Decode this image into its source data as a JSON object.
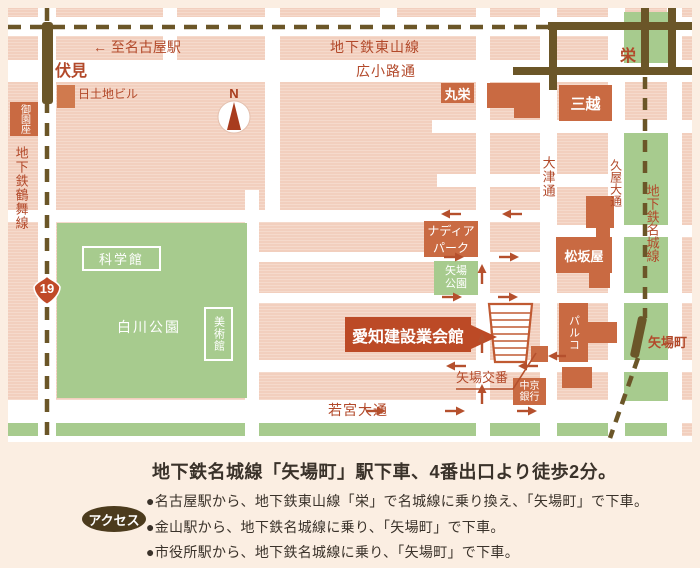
{
  "map": {
    "compass": "N",
    "route_number": "19",
    "stations": {
      "fushimi": "伏見",
      "sakae": "栄",
      "yabacho": "矢場町"
    },
    "lines": {
      "tsurumai": "地下鉄鶴舞線",
      "higashiyama": "地下鉄東山線",
      "meijo": "地下鉄名城線"
    },
    "streets": {
      "to_nagoya": "← 至名古屋駅",
      "hirokoji": "広小路通",
      "otsu": "大津通",
      "hisaya": "久屋大通",
      "wakamiya": "若宮大通"
    },
    "places": {
      "misonoza": "御園座",
      "nittochi": "日土地ビル",
      "maruei": "丸栄",
      "mitsukoshi": "三越",
      "matsuzakaya": "松坂屋",
      "parco": "パルコ",
      "nadya_line1": "ナディア",
      "nadya_line2": "パーク",
      "yaba_park_line1": "矢場",
      "yaba_park_line2": "公園",
      "kagakukan": "科学館",
      "bijutsukan": "美術館",
      "shirakawa_park": "白川公園",
      "chukyo_line1": "中京",
      "chukyo_line2": "銀行",
      "yaba_koban": "矢場交番",
      "kaikan": "愛知建設業会館"
    }
  },
  "access": {
    "heading": "地下鉄名城線「矢場町」駅下車、4番出口より徒歩2分。",
    "badge": "アクセス",
    "items": [
      "●名古屋駅から、地下鉄東山線「栄」で名城線に乗り換え、「矢場町」で下車。",
      "●金山駅から、地下鉄名城線に乗り、「矢場町」で下車。",
      "●市役所駅から、地下鉄名城線に乗り、「矢場町」で下車。"
    ]
  },
  "colors": {
    "block_pink": "#f2cfbe",
    "park_green": "#a7cb8e",
    "building_orange": "#c96a42",
    "line_brown": "#6b5628",
    "label_red": "#b2492a",
    "callout_red": "#bc4a26",
    "badge_brown": "#4c3b1d"
  }
}
